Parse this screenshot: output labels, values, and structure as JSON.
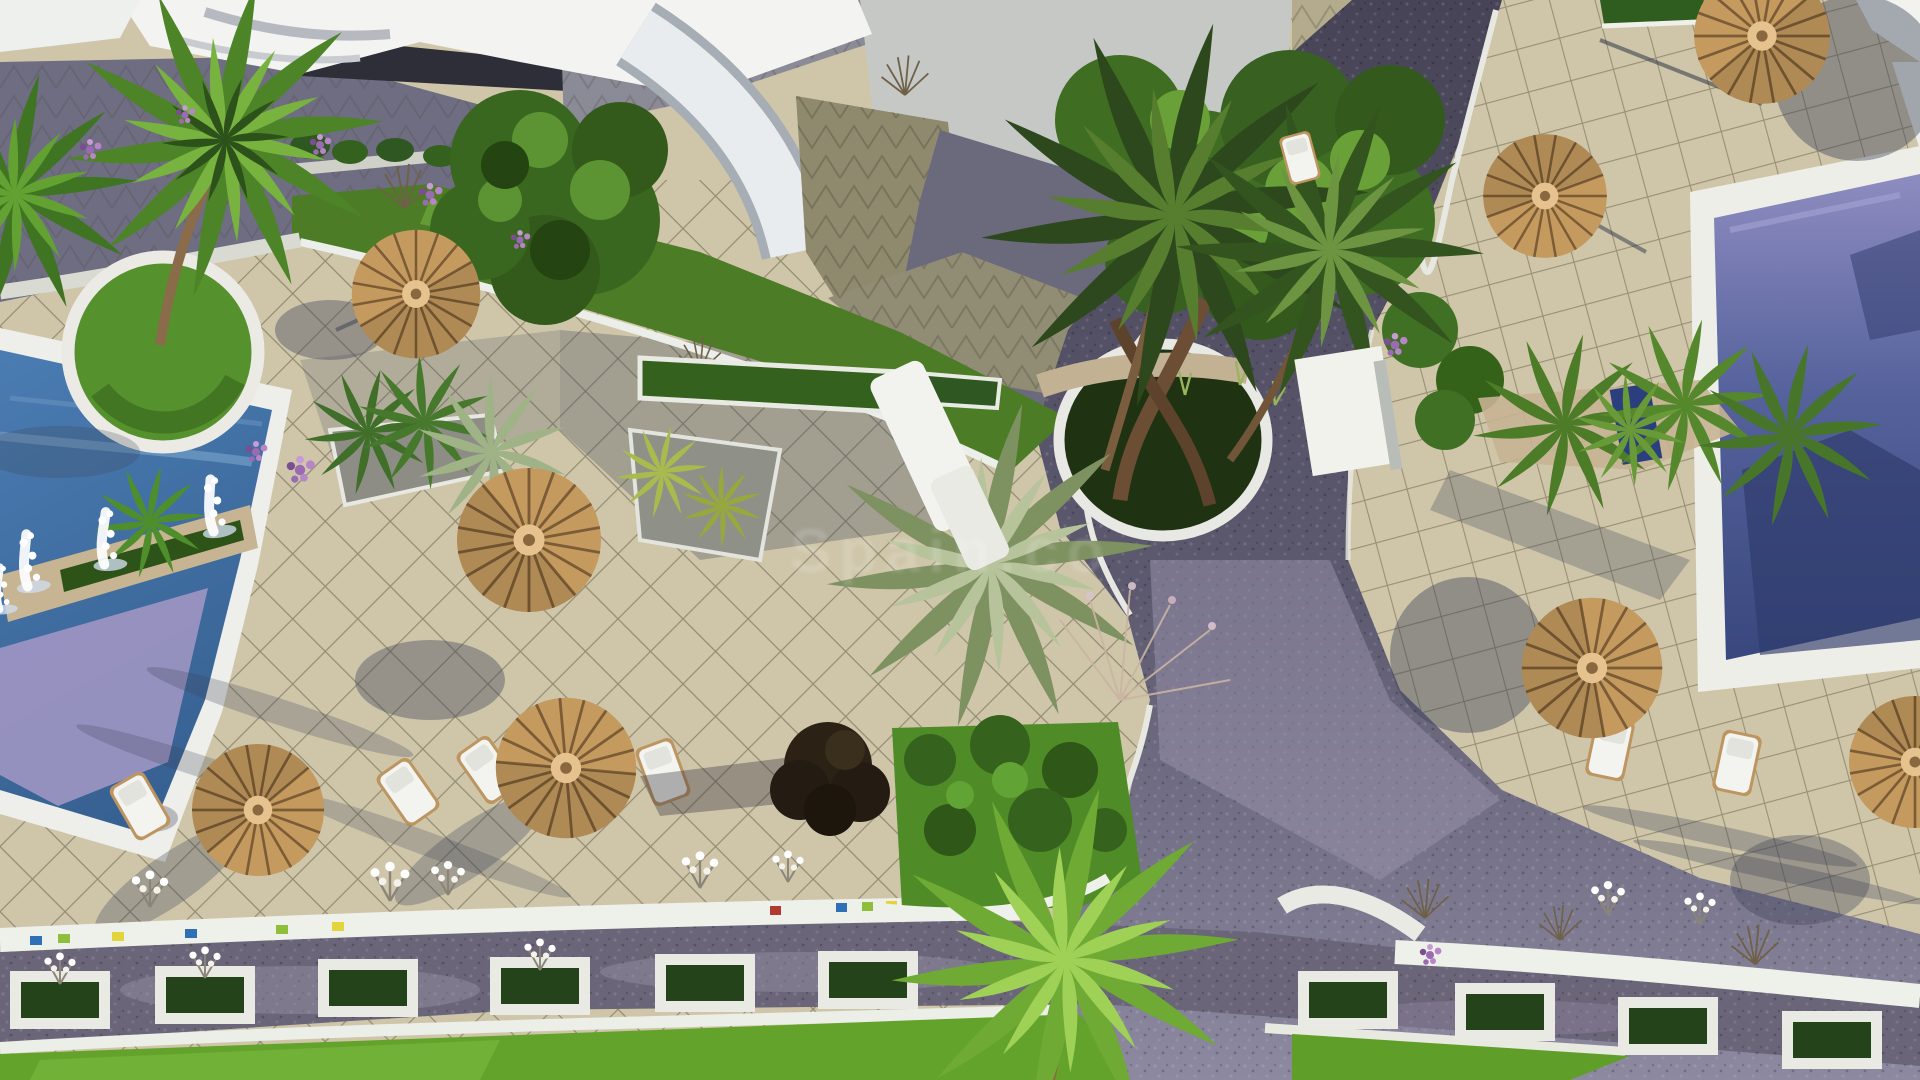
{
  "scene": {
    "type": "aerial-3d-architectural-render",
    "setting": "resort pool terraces with palm trees, thatched umbrellas, paved walkways and planted road verge",
    "watermark": {
      "text": "Spain.co"
    },
    "palette": {
      "paving_beige": "#cfc6aa",
      "grid_line": "#5f5a40",
      "cobble_path_dark": "#4b4960",
      "cobble_path_light": "#8d89a0",
      "road_cobble": "#6b6579",
      "left_pool_blue": "#4a7cb2",
      "left_pool_lavender": "#9d95c2",
      "right_pool_light": "#8e8cc0",
      "right_pool_deep": "#39477e",
      "lawn_green": "#63a32b",
      "hedge_green": "#2d5319",
      "palm_green": "#4f8a2b",
      "palm_dark": "#2c481c",
      "thatch": "#c49a5e",
      "thatch_line": "#7c5c36",
      "deck_white": "#efefe9",
      "roof_white": "#f3f4f1",
      "roof_grey": "#c6c8c5",
      "shadow_blue": "#394055"
    },
    "inventory": {
      "pools": 2,
      "thatched_umbrellas": 8,
      "sun_loungers": 9,
      "palm_trees": 10,
      "fountain_jets": 4,
      "road_planter_boxes": 10
    }
  }
}
